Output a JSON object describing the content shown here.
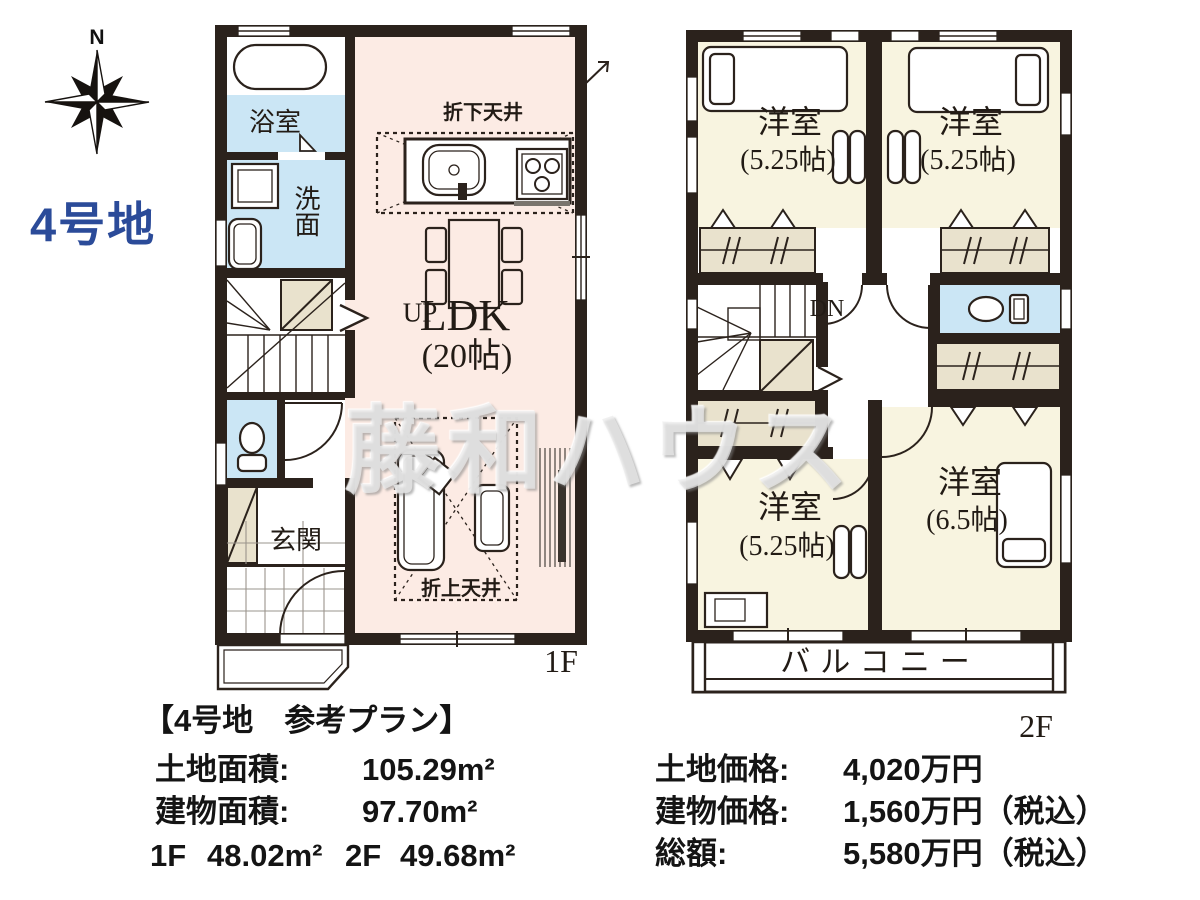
{
  "colors": {
    "wall": "#2b221c",
    "pink": "#fcebe4",
    "blue": "#cbe6f5",
    "beige": "#e9e2cd",
    "cream": "#f8f4e0",
    "accent": "#2b4b99"
  },
  "compass": {
    "north": "N"
  },
  "lot": {
    "name": "4号地"
  },
  "watermark": {
    "text": "藤和ハウス"
  },
  "floor1": {
    "label": "1F",
    "bathroom": "浴室",
    "washroom": "洗面",
    "stairs": "UP",
    "entrance": "玄関",
    "dropped_ceiling": "折下天井",
    "raised_ceiling": "折上天井",
    "ldk": {
      "name": "LDK",
      "size": "(20帖)"
    }
  },
  "floor2": {
    "label": "2F",
    "stairs": "DN",
    "balcony": "バルコニー",
    "bedroom_tl": {
      "name": "洋室",
      "size": "(5.25帖)"
    },
    "bedroom_tr": {
      "name": "洋室",
      "size": "(5.25帖)"
    },
    "bedroom_bl": {
      "name": "洋室",
      "size": "(5.25帖)"
    },
    "bedroom_br": {
      "name": "洋室",
      "size": "(6.5帖)"
    }
  },
  "info": {
    "title": "【4号地　参考プラン】",
    "land_area": {
      "label": "土地面積:",
      "value": "105.29m²"
    },
    "building_area": {
      "label": "建物面積:",
      "value": "97.70m²"
    },
    "floor_areas": {
      "f1_label": "1F",
      "f1_value": "48.02m²",
      "f2_label": "2F",
      "f2_value": "49.68m²"
    },
    "land_price": {
      "label": "土地価格:",
      "value": "4,020万円"
    },
    "building_price": {
      "label": "建物価格:",
      "value": "1,560万円（税込）"
    },
    "total_price": {
      "label": "総額:",
      "value": "5,580万円（税込）"
    }
  }
}
